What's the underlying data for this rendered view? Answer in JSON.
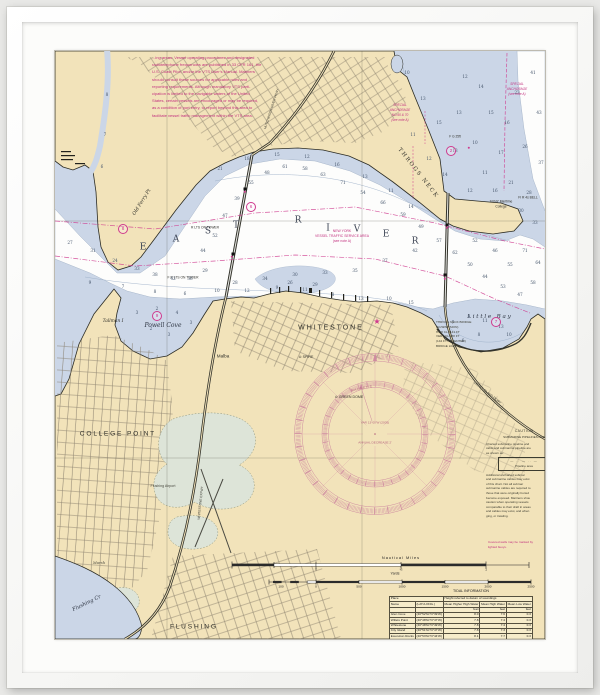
{
  "chart": {
    "colors": {
      "land": "#f2e3ba",
      "shallow_water": "#cbd6e7",
      "deep_water": "#fdfdfc",
      "magenta": "#cf3a8e",
      "note_magenta": "#c2317f",
      "rose": "#cf8ba0",
      "sounding": "#46566c",
      "marsh": "#dde4d8"
    },
    "notes": {
      "vts_note": {
        "lines": [
          "...ing areas.  Vessel operating procedures and designated",
          "radiotelephone frequencies are published in 33 CFR 161, the",
          "U.S. Coast Pilot, and/or the VTS User's Manual.  Mariners",
          "should consult these sources for applicable rules and",
          "reporting requirements.  Although mandatory VTS parti-",
          "cipation is limited to the navigable waters of the United",
          "States, certain vessels are encouraged or may be required,",
          "as a condition of port entry, to report beyond this area to",
          "facilitate vessel traffic management within the VTS area."
        ]
      },
      "vts_area_label": {
        "lines": [
          "NEW YORK",
          "VESSEL TRAFFIC SERVICE AREA",
          "(see note A)"
        ]
      },
      "special_anchorage": {
        "lines": [
          "SPECIAL",
          "ANCHORAGE",
          "NO.60 & 70",
          "(see note A)"
        ]
      },
      "special_anchorage_2": {
        "lines": [
          "SPECIAL",
          "ANCHORAGE",
          "(see note A)"
        ]
      },
      "bridge_note": {
        "lines": [
          "THROGS NECK BRIDGE",
          "(SUSPENSION)",
          "HOR CL 1141 FT",
          "VERT CL 138 FT",
          "(142 FT AT CENTER)",
          "BRIDGE LIGHTS"
        ]
      },
      "caution": {
        "title": "CAUTION",
        "subtitle": "SUBMARINE PIPELINES AND",
        "pipeline_symbol": "— ·· — ·· —",
        "pipeline_label": "Pipeline area",
        "body_lines": [
          "Charted submarine pipeline and",
          "cable and submarine pipeline are",
          "as shown as:"
        ],
        "body_lines_2": [
          "Additional uncharted submar",
          "and submarine cables may exist",
          "of this chart.  Not all submar",
          "submarine cables are required to",
          "those that were originally buried",
          "become exposed.  Mariners shou",
          "caution when operating vessels",
          "comparable to their draft in areas",
          "and cables may exist, and when",
          "ging, or trawling."
        ],
        "footer_lines": [
          "Covered wells may be marked by",
          "lighted buoys."
        ]
      }
    },
    "compass": {
      "magnetic_label": "MAGNETIC",
      "variation": "VAR 13°00'W (2005)",
      "annual_change": "ANNUAL DECREASE 2'"
    },
    "labels": [
      {
        "n": "water-label-east-e",
        "t": "E",
        "x": 88,
        "y": 197,
        "s": 9,
        "f": "serif",
        "c": "#3c4454"
      },
      {
        "n": "water-label-east-a",
        "t": "A",
        "x": 121,
        "y": 189,
        "s": 9,
        "f": "serif",
        "c": "#3c4454"
      },
      {
        "n": "water-label-east-s",
        "t": "S",
        "x": 153,
        "y": 181,
        "s": 9,
        "f": "serif",
        "c": "#3c4454"
      },
      {
        "n": "water-label-east-t",
        "t": "T",
        "x": 181,
        "y": 175,
        "s": 9,
        "f": "serif",
        "c": "#3c4454"
      },
      {
        "n": "water-label-river-r1",
        "t": "R",
        "x": 243,
        "y": 170,
        "s": 9,
        "f": "serif",
        "c": "#3c4454"
      },
      {
        "n": "water-label-river-i",
        "t": "I",
        "x": 273,
        "y": 178,
        "s": 9,
        "f": "serif",
        "c": "#3c4454"
      },
      {
        "n": "water-label-river-v",
        "t": "V",
        "x": 302,
        "y": 179,
        "s": 9,
        "f": "serif",
        "c": "#3c4454"
      },
      {
        "n": "water-label-river-e",
        "t": "E",
        "x": 331,
        "y": 184,
        "s": 9,
        "f": "serif",
        "c": "#3c4454"
      },
      {
        "n": "water-label-river-r2",
        "t": "R",
        "x": 360,
        "y": 191,
        "s": 9,
        "f": "serif",
        "c": "#3c4454"
      },
      {
        "n": "place-label-whitestone",
        "t": "W H I T E S T O N E",
        "x": 275,
        "y": 277,
        "s": 7,
        "c": "#2e2e28"
      },
      {
        "n": "place-label-college-point",
        "t": "C O L L E G E   P O I N T",
        "x": 62,
        "y": 384,
        "s": 6.6,
        "c": "#2e2e28"
      },
      {
        "n": "place-label-flushing",
        "t": "F L U S H I N G",
        "x": 138,
        "y": 577,
        "s": 6.6,
        "c": "#2e2e28"
      },
      {
        "n": "water-label-powell-cove",
        "t": "Powell Cove",
        "x": 108,
        "y": 275,
        "s": 6,
        "i": 1,
        "f": "serif",
        "c": "#2c3340"
      },
      {
        "n": "water-label-little-bay",
        "t": "L i t t l e   B a y",
        "x": 434,
        "y": 267,
        "s": 5.6,
        "i": 1,
        "f": "serif",
        "c": "#2c3340"
      },
      {
        "n": "place-label-tallman-island",
        "t": "Tallman I",
        "x": 58,
        "y": 271,
        "s": 4.4,
        "i": 1,
        "f": "serif",
        "c": "#2e2e28"
      },
      {
        "n": "place-label-malba",
        "t": "Malba",
        "x": 168,
        "y": 306,
        "s": 4.6,
        "c": "#2e2e28"
      },
      {
        "n": "place-label-old-ferry-pt",
        "t": "Old Ferry Pt",
        "x": 88,
        "y": 152,
        "s": 4.8,
        "i": 1,
        "f": "serif",
        "r": -58,
        "c": "#2e2e28"
      },
      {
        "n": "place-label-throgs-neck",
        "t": "T H R O G S   N E C K",
        "x": 362,
        "y": 122,
        "s": 5.4,
        "f": "serif",
        "r": 52,
        "c": "#2e2e28"
      },
      {
        "n": "landmark-label-suny-1",
        "t": "SUNY Maritime",
        "x": 446,
        "y": 151,
        "s": 3.3,
        "c": "#2e2e28"
      },
      {
        "n": "landmark-label-suny-2",
        "t": "College",
        "x": 446,
        "y": 156,
        "s": 3.3,
        "c": "#2e2e28"
      },
      {
        "n": "water-label-flushing-creek",
        "t": "Flushing Cr",
        "x": 32,
        "y": 553,
        "s": 5.2,
        "i": 1,
        "f": "serif",
        "r": -26,
        "c": "#2c3340"
      },
      {
        "n": "place-label-marsh",
        "t": "Marsh",
        "x": 44,
        "y": 512,
        "s": 3.8,
        "i": 1,
        "f": "serif",
        "c": "#4a4a40"
      },
      {
        "n": "place-label-flushing-airport",
        "t": "Flushing Airport",
        "x": 108,
        "y": 436,
        "s": 3.6,
        "c": "#4a4a40"
      },
      {
        "n": "landmark-label-green-dome",
        "t": "⊙ GREEN DOME",
        "x": 294,
        "y": 347,
        "s": 3.6,
        "c": "#2e2e28"
      },
      {
        "n": "landmark-label-spire",
        "t": "⊙ SPIRE",
        "x": 251,
        "y": 307,
        "s": 3.6,
        "c": "#2e2e28"
      },
      {
        "n": "bridge-label-r-lts-on-tower",
        "t": "R LTS ON TOWER",
        "x": 150,
        "y": 177,
        "s": 3.3,
        "c": "#2e2e28"
      },
      {
        "n": "bridge-label-f-r-lts-on-tower",
        "t": "F R LTS ON TOWER",
        "x": 128,
        "y": 227,
        "s": 3.3,
        "c": "#2e2e28"
      },
      {
        "n": "road-label-hutchinson-river-pkwy",
        "t": "HUTCHINSON RIVER PKWY",
        "x": 217,
        "y": 58,
        "s": 3.2,
        "r": -72,
        "c": "#3a3a32"
      },
      {
        "n": "road-label-whitestone-expwy",
        "t": "WHITESTONE EXPWY",
        "x": 146,
        "y": 452,
        "s": 3.2,
        "r": -84,
        "c": "#3a3a32"
      },
      {
        "n": "road-label-cross-island-pkwy",
        "t": "CROSS ISLAND PKWY",
        "x": 432,
        "y": 342,
        "s": 3.2,
        "r": 38,
        "c": "#3a3a32"
      },
      {
        "n": "light-label-fl-r-bell",
        "t": "Fl R 4s BELL",
        "x": 473,
        "y": 147,
        "s": 3.3,
        "c": "#2e2e28"
      },
      {
        "n": "light-label-f-g",
        "t": "F G 25ft",
        "x": 400,
        "y": 86,
        "s": 3.2,
        "c": "#2e2e28"
      },
      {
        "n": "scale-label-nautical-miles",
        "t": "Nautical Miles",
        "x": 346,
        "y": 507,
        "s": 3.9,
        "ls": 1,
        "c": "#222222"
      },
      {
        "n": "scale-label-nm-0",
        "t": "0",
        "x": 261,
        "y": 519,
        "s": 3.3,
        "c": "#222222"
      },
      {
        "n": "scale-label-nm-half",
        "t": "½",
        "x": 346,
        "y": 519,
        "s": 3.3,
        "c": "#222222"
      },
      {
        "n": "scale-label-nm-1",
        "t": "1",
        "x": 431,
        "y": 519,
        "s": 3.3,
        "c": "#222222"
      },
      {
        "n": "scale-label-yards",
        "t": "Yards",
        "x": 340,
        "y": 523,
        "s": 3.5,
        "c": "#222222"
      },
      {
        "n": "scale-label-yd-100",
        "t": "100",
        "x": 226,
        "y": 536,
        "s": 3.1,
        "c": "#222222"
      },
      {
        "n": "scale-label-yd-0",
        "t": "0",
        "x": 261,
        "y": 536,
        "s": 3.1,
        "c": "#222222"
      },
      {
        "n": "scale-label-yd-500",
        "t": "500",
        "x": 304,
        "y": 536,
        "s": 3.1,
        "c": "#222222"
      },
      {
        "n": "scale-label-yd-1000",
        "t": "1000",
        "x": 347,
        "y": 536,
        "s": 3.1,
        "c": "#222222"
      },
      {
        "n": "scale-label-yd-1500",
        "t": "1500",
        "x": 390,
        "y": 536,
        "s": 3.1,
        "c": "#222222"
      },
      {
        "n": "scale-label-yd-2000",
        "t": "2000",
        "x": 433,
        "y": 536,
        "s": 3.1,
        "c": "#222222"
      },
      {
        "n": "scale-label-yd-2500",
        "t": "2500",
        "x": 476,
        "y": 536,
        "s": 3.1,
        "c": "#222222"
      },
      {
        "n": "tide-table-title",
        "t": "TIDAL INFORMATION",
        "x": 416,
        "y": 541,
        "s": 3.6,
        "c": "#222222"
      },
      {
        "n": "compass-label-magnetic",
        "t": "MAGNETIC",
        "x": 307,
        "y": 338,
        "s": 3.3,
        "r": -12,
        "ls": 0.6,
        "c": "#b4637e"
      },
      {
        "n": "compass-label-variation",
        "t": "VAR 13°00'W (2005)",
        "x": 320,
        "y": 372,
        "s": 3.1,
        "c": "#b4637e"
      },
      {
        "n": "compass-label-annual-change",
        "t": "ANNUAL DECREASE 2'",
        "x": 320,
        "y": 392,
        "s": 3.1,
        "c": "#b4637e"
      }
    ],
    "symbols": {
      "circled_numbers": [
        {
          "v": "8",
          "x": 68,
          "y": 178
        },
        {
          "v": "6",
          "x": 196,
          "y": 156
        },
        {
          "v": "9",
          "x": 102,
          "y": 265
        },
        {
          "v": "7",
          "x": 441,
          "y": 271
        },
        {
          "v": "2",
          "x": 396,
          "y": 100
        }
      ],
      "star": {
        "glyph": "★",
        "x": 322,
        "y": 271
      },
      "light_dots": [
        {
          "x": 414,
          "y": 97
        },
        {
          "x": 190,
          "y": 141
        },
        {
          "x": 177,
          "y": 206
        },
        {
          "x": 392,
          "y": 177
        },
        {
          "x": 390,
          "y": 228
        }
      ]
    },
    "soundings": [
      [
        15,
        192,
        27
      ],
      [
        38,
        200,
        31
      ],
      [
        60,
        210,
        24
      ],
      [
        82,
        218,
        33
      ],
      [
        100,
        224,
        38
      ],
      [
        118,
        228,
        42
      ],
      [
        135,
        228,
        36
      ],
      [
        150,
        220,
        29
      ],
      [
        148,
        200,
        44
      ],
      [
        160,
        185,
        52
      ],
      [
        170,
        165,
        47
      ],
      [
        182,
        148,
        39
      ],
      [
        196,
        132,
        55
      ],
      [
        212,
        122,
        48
      ],
      [
        230,
        116,
        61
      ],
      [
        250,
        118,
        58
      ],
      [
        268,
        124,
        63
      ],
      [
        288,
        132,
        71
      ],
      [
        308,
        142,
        54
      ],
      [
        328,
        152,
        66
      ],
      [
        348,
        164,
        59
      ],
      [
        366,
        176,
        49
      ],
      [
        384,
        190,
        57
      ],
      [
        400,
        202,
        62
      ],
      [
        415,
        214,
        50
      ],
      [
        430,
        226,
        44
      ],
      [
        448,
        236,
        53
      ],
      [
        465,
        244,
        47
      ],
      [
        478,
        232,
        58
      ],
      [
        483,
        212,
        64
      ],
      [
        470,
        200,
        71
      ],
      [
        455,
        214,
        55
      ],
      [
        440,
        200,
        46
      ],
      [
        420,
        190,
        52
      ],
      [
        360,
        200,
        42
      ],
      [
        330,
        210,
        37
      ],
      [
        300,
        220,
        35
      ],
      [
        270,
        222,
        33
      ],
      [
        240,
        224,
        30
      ],
      [
        210,
        228,
        34
      ],
      [
        180,
        232,
        28
      ],
      [
        235,
        232,
        26
      ],
      [
        260,
        234,
        29
      ],
      [
        192,
        108,
        18
      ],
      [
        222,
        104,
        15
      ],
      [
        252,
        106,
        12
      ],
      [
        282,
        114,
        16
      ],
      [
        310,
        126,
        13
      ],
      [
        336,
        140,
        11
      ],
      [
        356,
        156,
        14
      ],
      [
        165,
        118,
        21
      ],
      [
        35,
        232,
        9
      ],
      [
        68,
        236,
        7
      ],
      [
        100,
        241,
        8
      ],
      [
        130,
        243,
        6
      ],
      [
        162,
        240,
        10
      ],
      [
        192,
        240,
        12
      ],
      [
        222,
        237,
        9
      ],
      [
        250,
        239,
        11
      ],
      [
        278,
        244,
        8
      ],
      [
        306,
        248,
        13
      ],
      [
        334,
        248,
        10
      ],
      [
        356,
        252,
        15
      ],
      [
        82,
        262,
        3
      ],
      [
        102,
        258,
        2
      ],
      [
        122,
        262,
        4
      ],
      [
        136,
        272,
        3
      ],
      [
        96,
        278,
        2
      ],
      [
        114,
        284,
        3
      ],
      [
        398,
        272,
        7
      ],
      [
        414,
        266,
        9
      ],
      [
        430,
        270,
        11
      ],
      [
        446,
        276,
        13
      ],
      [
        454,
        284,
        10
      ],
      [
        424,
        284,
        8
      ],
      [
        408,
        290,
        6
      ],
      [
        352,
        22,
        10
      ],
      [
        368,
        48,
        13
      ],
      [
        384,
        72,
        15
      ],
      [
        358,
        84,
        11
      ],
      [
        374,
        108,
        12
      ],
      [
        390,
        124,
        14
      ],
      [
        404,
        62,
        13
      ],
      [
        410,
        26,
        12
      ],
      [
        420,
        92,
        10
      ],
      [
        430,
        122,
        11
      ],
      [
        436,
        62,
        15
      ],
      [
        426,
        36,
        14
      ],
      [
        446,
        102,
        17
      ],
      [
        452,
        72,
        16
      ],
      [
        456,
        132,
        21
      ],
      [
        462,
        42,
        23
      ],
      [
        470,
        96,
        26
      ],
      [
        474,
        142,
        28
      ],
      [
        478,
        22,
        41
      ],
      [
        484,
        62,
        43
      ],
      [
        486,
        112,
        37
      ],
      [
        480,
        172,
        33
      ],
      [
        466,
        160,
        30
      ],
      [
        440,
        140,
        16
      ],
      [
        400,
        100,
        13
      ],
      [
        415,
        140,
        12
      ],
      [
        52,
        44,
        8
      ],
      [
        50,
        84,
        7
      ],
      [
        47,
        116,
        6
      ]
    ],
    "scales": {
      "nm_title": "Nautical Miles",
      "nm_tick_labels": [
        "0",
        "½",
        "1"
      ],
      "yd_title": "Yards",
      "yd_tick_labels": [
        "100",
        "0",
        "500",
        "1000",
        "1500",
        "2000",
        "2500"
      ]
    },
    "tide_table": {
      "title": "TIDAL INFORMATION",
      "header": {
        "place": "Place",
        "height": "Height referred to datum of soundings",
        "name": "Name",
        "latlong": "(LAT./LONG.)",
        "cols": [
          "Mean Higher High Water",
          "Mean High Water",
          "Mean Low Water"
        ],
        "units": "feet"
      },
      "rows": [
        [
          "Glen Cove",
          "(40°52'N/73°39'W)",
          "8.0",
          "7.6",
          "0.3"
        ],
        [
          "Willets Point",
          "(40°48'N/73°47'W)",
          "7.8",
          "7.4",
          "0.3"
        ],
        [
          "Whitestone",
          "(40°48'N/73°49'W)",
          "7.8",
          "7.4",
          "0.3"
        ],
        [
          "City Island",
          "(40°51'N/73°47'W)",
          "7.8",
          "7.3",
          "0.3"
        ],
        [
          "Execution Rocks",
          "(40°53'N/73°44'W)",
          "8.1",
          "7.7",
          "0.3"
        ]
      ]
    }
  }
}
